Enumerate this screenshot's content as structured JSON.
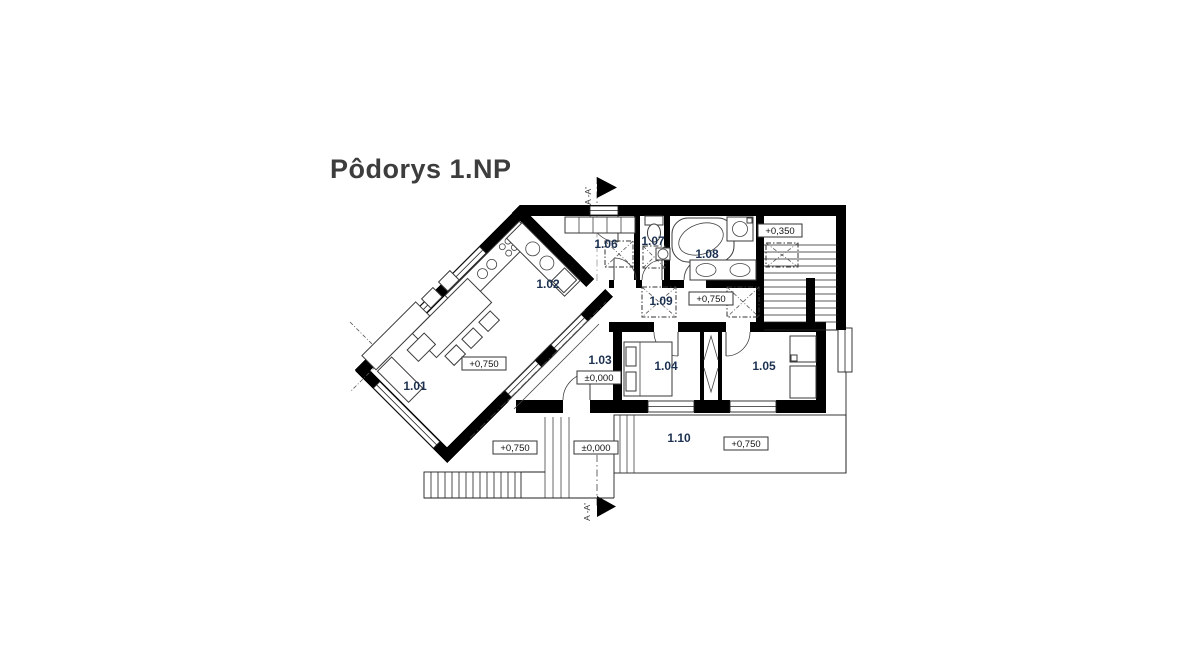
{
  "title": "Pôdorys 1.NP",
  "section_markers": {
    "top": "A -A'",
    "bottom": "A -A'"
  },
  "rooms": [
    {
      "id": "1.01"
    },
    {
      "id": "1.02"
    },
    {
      "id": "1.03"
    },
    {
      "id": "1.04"
    },
    {
      "id": "1.05"
    },
    {
      "id": "1.06"
    },
    {
      "id": "1.07"
    },
    {
      "id": "1.08"
    },
    {
      "id": "1.09"
    },
    {
      "id": "1.10"
    }
  ],
  "elevations": [
    {
      "value": "+0,750",
      "location": "living-room"
    },
    {
      "value": "+0,350",
      "location": "stair-landing"
    },
    {
      "value": "+0,750",
      "location": "corridor"
    },
    {
      "value": "±0,000",
      "location": "hall"
    },
    {
      "value": "+0,750",
      "location": "terrace-left"
    },
    {
      "value": "±0,000",
      "location": "ground-strip"
    },
    {
      "value": "+0,750",
      "location": "terrace-south"
    }
  ],
  "colors": {
    "walls": "#000000",
    "room_label": "#1c3150",
    "background": "#ffffff"
  }
}
